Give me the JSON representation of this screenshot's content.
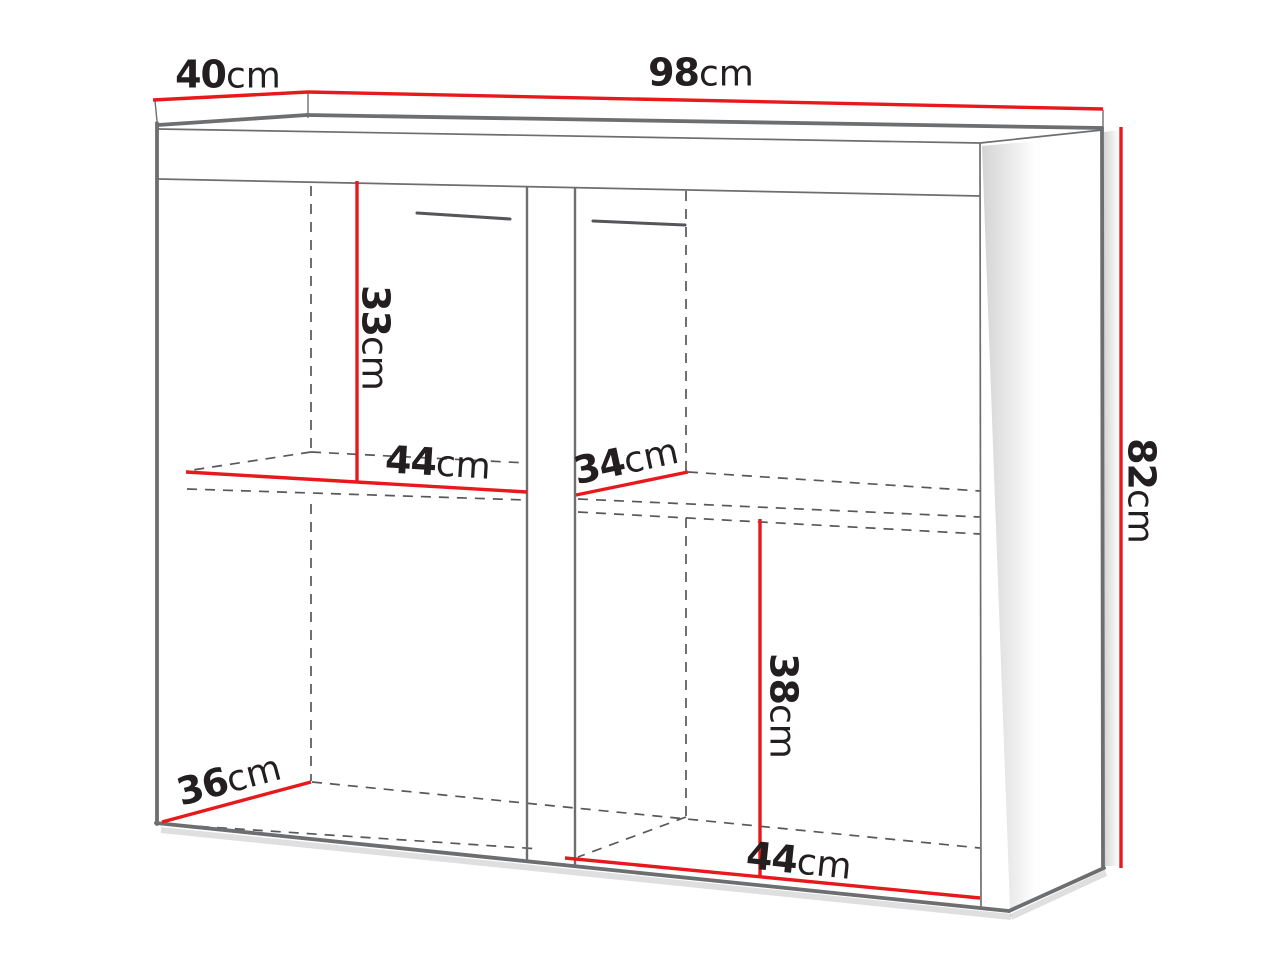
{
  "diagram_title": "cabinet-dimension-diagram",
  "colors": {
    "accent_red": "#e8191c",
    "outline_gray": "#6d6e70",
    "dashed_gray": "#57585a",
    "text": "#231f20",
    "background": "#ffffff"
  },
  "dimensions": {
    "top_depth": {
      "value": "40",
      "unit": "cm"
    },
    "top_width": {
      "value": "98",
      "unit": "cm"
    },
    "height": {
      "value": "82",
      "unit": "cm"
    },
    "upper_section_height": {
      "value": "33",
      "unit": "cm"
    },
    "left_shelf_width": {
      "value": "44",
      "unit": "cm"
    },
    "right_shelf_depth": {
      "value": "34",
      "unit": "cm"
    },
    "lower_section_height": {
      "value": "38",
      "unit": "cm"
    },
    "bottom_width": {
      "value": "44",
      "unit": "cm"
    },
    "bottom_depth": {
      "value": "36",
      "unit": "cm"
    }
  }
}
